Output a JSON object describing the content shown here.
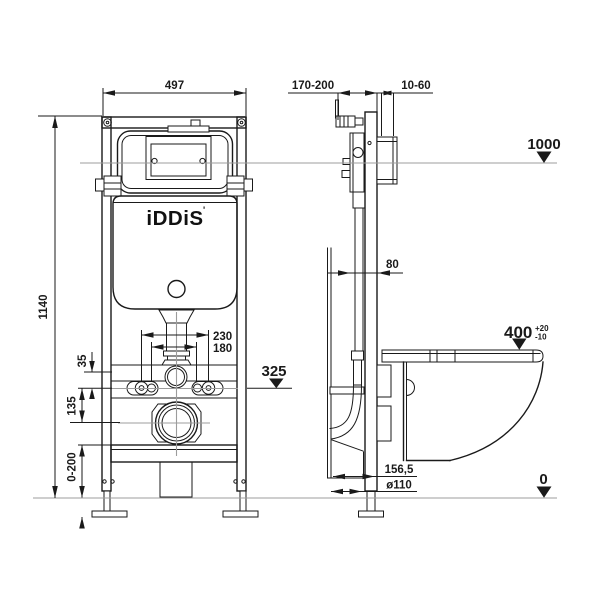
{
  "brand": {
    "logo": "iDDiS",
    "logo_mark": "'"
  },
  "dims": {
    "front_width": "497",
    "front_height": "1140",
    "depth_range": "170-200",
    "bracket_range": "10-60",
    "frame_depth": "80",
    "bolt_span_outer": "230",
    "bolt_span_inner": "180",
    "offset_small": "35",
    "offset_mid": "135",
    "leg_adjust": "0-200",
    "outlet_offset": "156,5",
    "outlet_diameter": "ø110",
    "seat_height": "400",
    "seat_tol_plus": "+20",
    "seat_tol_minus": "-10"
  },
  "levels": {
    "flush_plate": "1000",
    "bowl_mount": "325",
    "floor": "0"
  }
}
